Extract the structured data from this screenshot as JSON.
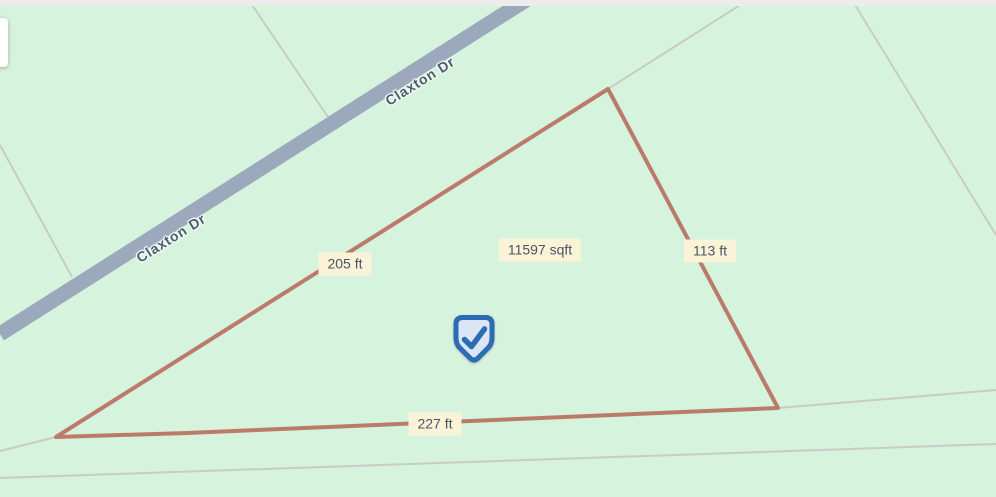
{
  "map": {
    "background_color": "#d6f3dd",
    "topbar_color": "#edecec",
    "road": {
      "name": "Claxton Dr",
      "color": "#9ca9bd",
      "casing_color": "#e8f1e6",
      "width": 15,
      "line": {
        "x1": 0,
        "y1": 334,
        "x2": 526,
        "y2": 0
      },
      "label_color": "#4e5c6d",
      "labels": [
        {
          "text": "Claxton Dr",
          "x": 420,
          "y": 81,
          "angle": -32
        },
        {
          "text": "Claxton Dr",
          "x": 171,
          "y": 238,
          "angle": -32
        }
      ]
    },
    "parcel_lines": {
      "color": "#c7ccc8",
      "width": 2,
      "segments": [
        [
          252,
          5,
          328,
          117
        ],
        [
          0,
          145,
          72,
          277
        ],
        [
          748,
          0,
          608,
          89
        ],
        [
          852,
          0,
          996,
          235
        ],
        [
          778,
          408,
          996,
          390
        ],
        [
          0,
          478,
          996,
          444
        ],
        [
          0,
          451,
          56,
          437
        ]
      ]
    },
    "lot_boundary": {
      "color": "#bc7a6b",
      "width": 4,
      "vertices": [
        [
          608,
          89
        ],
        [
          778,
          408
        ],
        [
          187,
          433
        ],
        [
          56,
          437
        ]
      ]
    },
    "measurements": {
      "label_bg": "#fbf3d7",
      "label_text_color": "#4a5463",
      "items": [
        {
          "id": "left-edge-length",
          "text": "205 ft",
          "x": 345,
          "y": 264
        },
        {
          "id": "lot-area",
          "text": "11597 sqft",
          "x": 540,
          "y": 250
        },
        {
          "id": "right-edge-length",
          "text": "113 ft",
          "x": 710,
          "y": 251
        },
        {
          "id": "bottom-edge-length",
          "text": "227 ft",
          "x": 435,
          "y": 424
        }
      ]
    },
    "marker": {
      "x": 474,
      "y": 340,
      "border_color": "#2b6cb5",
      "fill_color": "#dce5f6",
      "check_color": "#2b6cb5"
    }
  }
}
